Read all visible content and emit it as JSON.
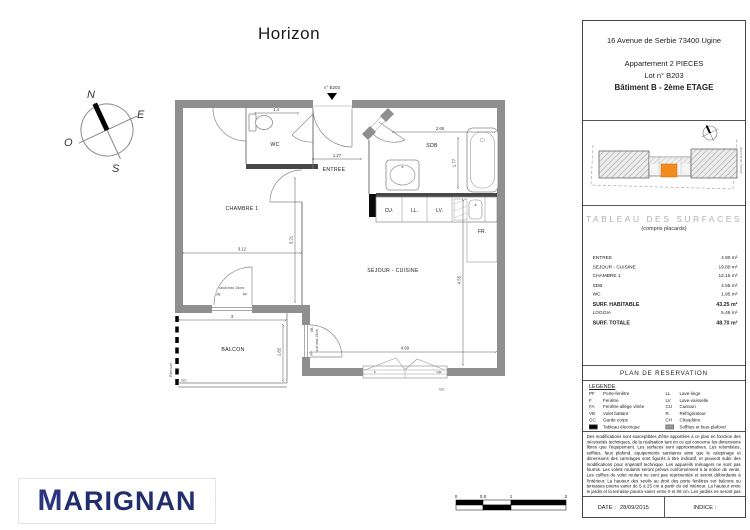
{
  "title": "Horizon",
  "compass": {
    "n": "N",
    "e": "E",
    "s": "S",
    "o": "O"
  },
  "plan": {
    "unit": "n° B203",
    "rooms": {
      "wc": "WC",
      "entree": "ENTREE",
      "chambre": "CHAMBRE 1",
      "sdb": "SDB",
      "sejour": "SEJOUR - CUISINE",
      "balcon": "BALCON"
    },
    "dims": {
      "wc_w": "1.4",
      "entree_w": "1.27",
      "sdb_w": "2.68",
      "sdb_h": "1.77",
      "chambre_h": "3.21",
      "chambre_w": "3.12",
      "sejour_h": "4.55",
      "sejour_w": "4.69",
      "balcon_w": "3",
      "balcon_h": "1.82"
    },
    "fixtures": {
      "cu": "CU.",
      "ll": "LL.",
      "lv": "LV.",
      "fr": "FR."
    },
    "marks": {
      "gc_balcon": "GC",
      "gc_sejour": "GC",
      "f": "F",
      "vr": "VR",
      "pf_chambre": "PF",
      "vb_chambre": "VB",
      "seuil_chambre": "seuil max 15cm",
      "pf_sejour": "PF",
      "vb_sejour": "VB",
      "seuil_sejour": "seuil max 15cm",
      "pare_vue": "Pare-vue"
    }
  },
  "sidebar": {
    "address": "16 Avenue de Serbie 73400 Ugine",
    "apartment": "Appartement 2 PIECES",
    "lot": "Lot n° B203",
    "building": "Bâtiment B - 2ème ETAGE",
    "sitemap": {
      "street": "Avenue de Serbie"
    },
    "surfaces": {
      "title": "TABLEAU DES SURFACES",
      "subtitle": "(compris placards)",
      "rows": [
        {
          "label": "ENTREE",
          "value": "4.80 m²"
        },
        {
          "label": "SEJOUR - CUISINE",
          "value": "19.80 m²"
        },
        {
          "label": "CHAMBRE 1",
          "value": "12.15 m²"
        },
        {
          "label": "SDB",
          "value": "4.55 m²"
        },
        {
          "label": "WC",
          "value": "1.95 m²"
        },
        {
          "label": "SURF. HABITABLE",
          "value": "43.25 m²"
        },
        {
          "label": "LOGGIA",
          "value": "5.45 m²"
        },
        {
          "label": "SURF. TOTALE",
          "value": "48.70 m²"
        }
      ]
    },
    "reservation_title": "PLAN DE RESERVATION",
    "legend": {
      "title": "LEGENDE",
      "left": [
        {
          "abbr": "PF",
          "label": "Porte-fenêtre"
        },
        {
          "abbr": "F",
          "label": "Fenêtre"
        },
        {
          "abbr": "FA",
          "label": "Fenêtre allège vitrée"
        },
        {
          "abbr": "VB",
          "label": "Volet battant"
        },
        {
          "abbr": "GC",
          "label": "Garde corps"
        },
        {
          "abbr": "",
          "label": "Tableau électrique"
        }
      ],
      "right": [
        {
          "abbr": "LL",
          "label": "Lave-linge"
        },
        {
          "abbr": "LV",
          "label": "Lave-vaisselle"
        },
        {
          "abbr": "CU",
          "label": "Cuisson"
        },
        {
          "abbr": "R.",
          "label": "Réfrigérateur"
        },
        {
          "abbr": "CH",
          "label": "Chaudière"
        },
        {
          "abbr": "",
          "label": "Soffites et faux-plafond"
        }
      ]
    },
    "disclaimer": "Des modifications sont susceptibles d'être apportées à ce plan en fonction des nécessités techniques, de la réalisation tant en ce qui concerne les dimensions libres que l'équipement. Les surfaces sont approximatives. Les retombées, soffites, faux plafond, équipements sanitaires ainsi que le calepinage et dimensions des carrelages sont figurés à titre indicatif, et peuvent subir des modifications pour impératif technique. Les appareils ménagers ne sont pas fournis. Les volets roulants seront prévus conformément à la notice de vente. Les coffres de volet roulant ne sont pas représentés et seront débordants à l'intérieur. La hauteur des seuils au droit des porte fenêtres sur balcons ou terrasses pourra varier de 5 à 25 cm à partir du sol intérieur. La hauteur entre le jardin et la terrasse pourra varier entre 0 et 06 cm. Les jardins ne seront pas nécessairement plats et pourront comporter des talus et des pentes.",
    "date_label": "DATE :",
    "date_value": "28/09/2015",
    "indice_label": "INDICE :"
  },
  "logo": {
    "first": "M",
    "rest": "ARIGNAN"
  },
  "scalebar": {
    "t0": "0",
    "t05": "0.5",
    "t1": "1",
    "t2": "2"
  },
  "colors": {
    "accent_orange": "#F28A1E",
    "navy": "#222D6E",
    "wall_gray": "#8F8F8F"
  }
}
